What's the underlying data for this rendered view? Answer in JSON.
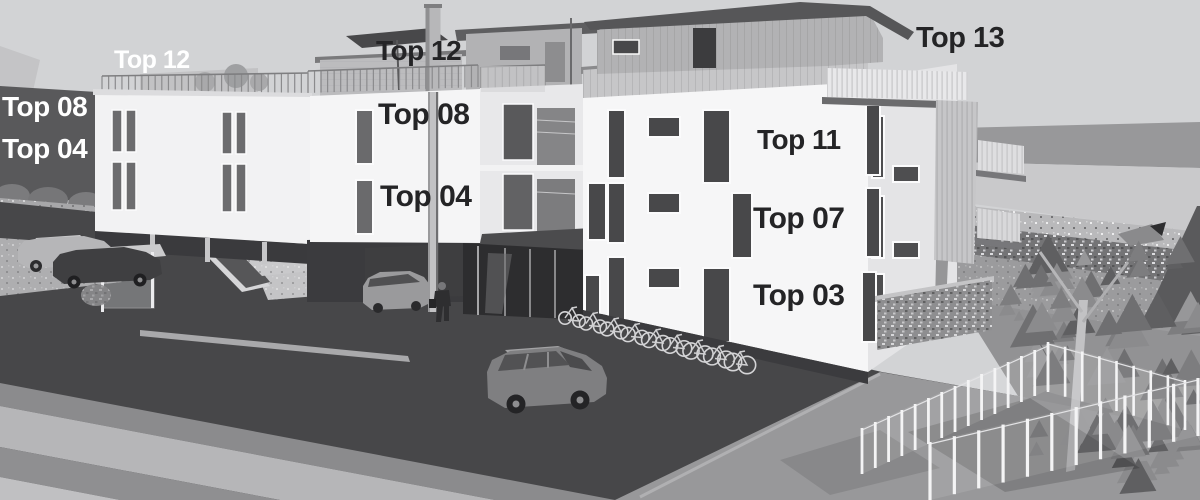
{
  "title": "Apartment building exterior rendering with unit labels",
  "labels": [
    {
      "id": "top-12-left",
      "text": "Top 12",
      "style": "light"
    },
    {
      "id": "top-08-left",
      "text": "Top 08",
      "style": "light"
    },
    {
      "id": "top-04-left",
      "text": "Top 04",
      "style": "light"
    },
    {
      "id": "top-12-center",
      "text": "Top 12",
      "style": "dark"
    },
    {
      "id": "top-08-center",
      "text": "Top 08",
      "style": "dark"
    },
    {
      "id": "top-04-center",
      "text": "Top 04",
      "style": "dark"
    },
    {
      "id": "top-11",
      "text": "Top 11",
      "style": "dark"
    },
    {
      "id": "top-07",
      "text": "Top 07",
      "style": "dark"
    },
    {
      "id": "top-03",
      "text": "Top 03",
      "style": "dark"
    },
    {
      "id": "top-13",
      "text": "Top 13",
      "style": "dark"
    }
  ],
  "colors": {
    "label_dark": "#242426",
    "label_light": "#ffffff",
    "sky": "#d2d3d5",
    "asphalt": "#474749",
    "facade_white": "#f4f4f5",
    "background_wall_dark": "#59595b"
  }
}
